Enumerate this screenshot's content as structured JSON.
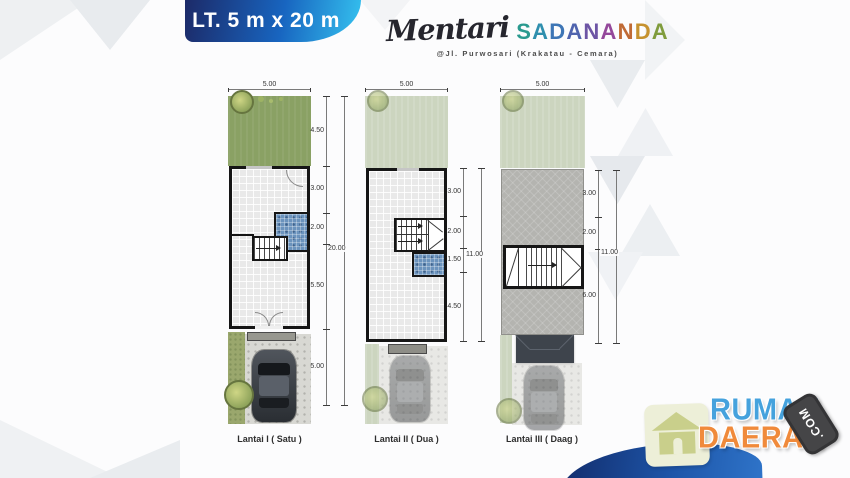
{
  "header": {
    "badge_label": "LT. 5 m x 20 m",
    "brand_script": "Mentari",
    "brand_caps": "SADANANDA",
    "brand_letters": [
      {
        "ch": "S",
        "color": "#2a9a8f"
      },
      {
        "ch": "A",
        "color": "#2f8fae"
      },
      {
        "ch": "D",
        "color": "#3e76b6"
      },
      {
        "ch": "A",
        "color": "#4f63ae"
      },
      {
        "ch": "N",
        "color": "#6d55a5"
      },
      {
        "ch": "A",
        "color": "#94489b"
      },
      {
        "ch": "N",
        "color": "#c06a35"
      },
      {
        "ch": "D",
        "color": "#c6922f"
      },
      {
        "ch": "A",
        "color": "#7f9c3c"
      }
    ],
    "address": "@Jl. Purwosari (Krakatau - Cemara)"
  },
  "plans": [
    {
      "name": "lantai-1",
      "label": "Lantai I ( Satu )",
      "width_dim": "5.00",
      "total_dim": "20.00",
      "segments": [
        "4.50",
        "3.00",
        "2.00",
        "5.50",
        "5.00"
      ]
    },
    {
      "name": "lantai-2",
      "label": "Lantai II ( Dua )",
      "width_dim": "5.00",
      "total_dim": "11.00",
      "segments": [
        "3.00",
        "2.00",
        "1.50",
        "4.50"
      ]
    },
    {
      "name": "lantai-3",
      "label": "Lantai III ( Daag )",
      "width_dim": "5.00",
      "total_dim": "11.00",
      "segments": [
        "3.00",
        "2.00",
        "6.00"
      ]
    }
  ],
  "logo": {
    "word_top": "RUMAH",
    "word_bottom": "DAERAH",
    "badge": ".COM"
  },
  "colors": {
    "badge_gradient_start": "#1c2a68",
    "badge_gradient_end": "#35c3f0",
    "grass": "#8aa164",
    "grass_faded": "#ccd5bf",
    "roof_deck": "#b4b4b0",
    "bath_tile": "#6b93bd",
    "wave_blue": "#1d55a8",
    "logo_blue": "#45a2dd",
    "logo_orange": "#f08a3b"
  }
}
